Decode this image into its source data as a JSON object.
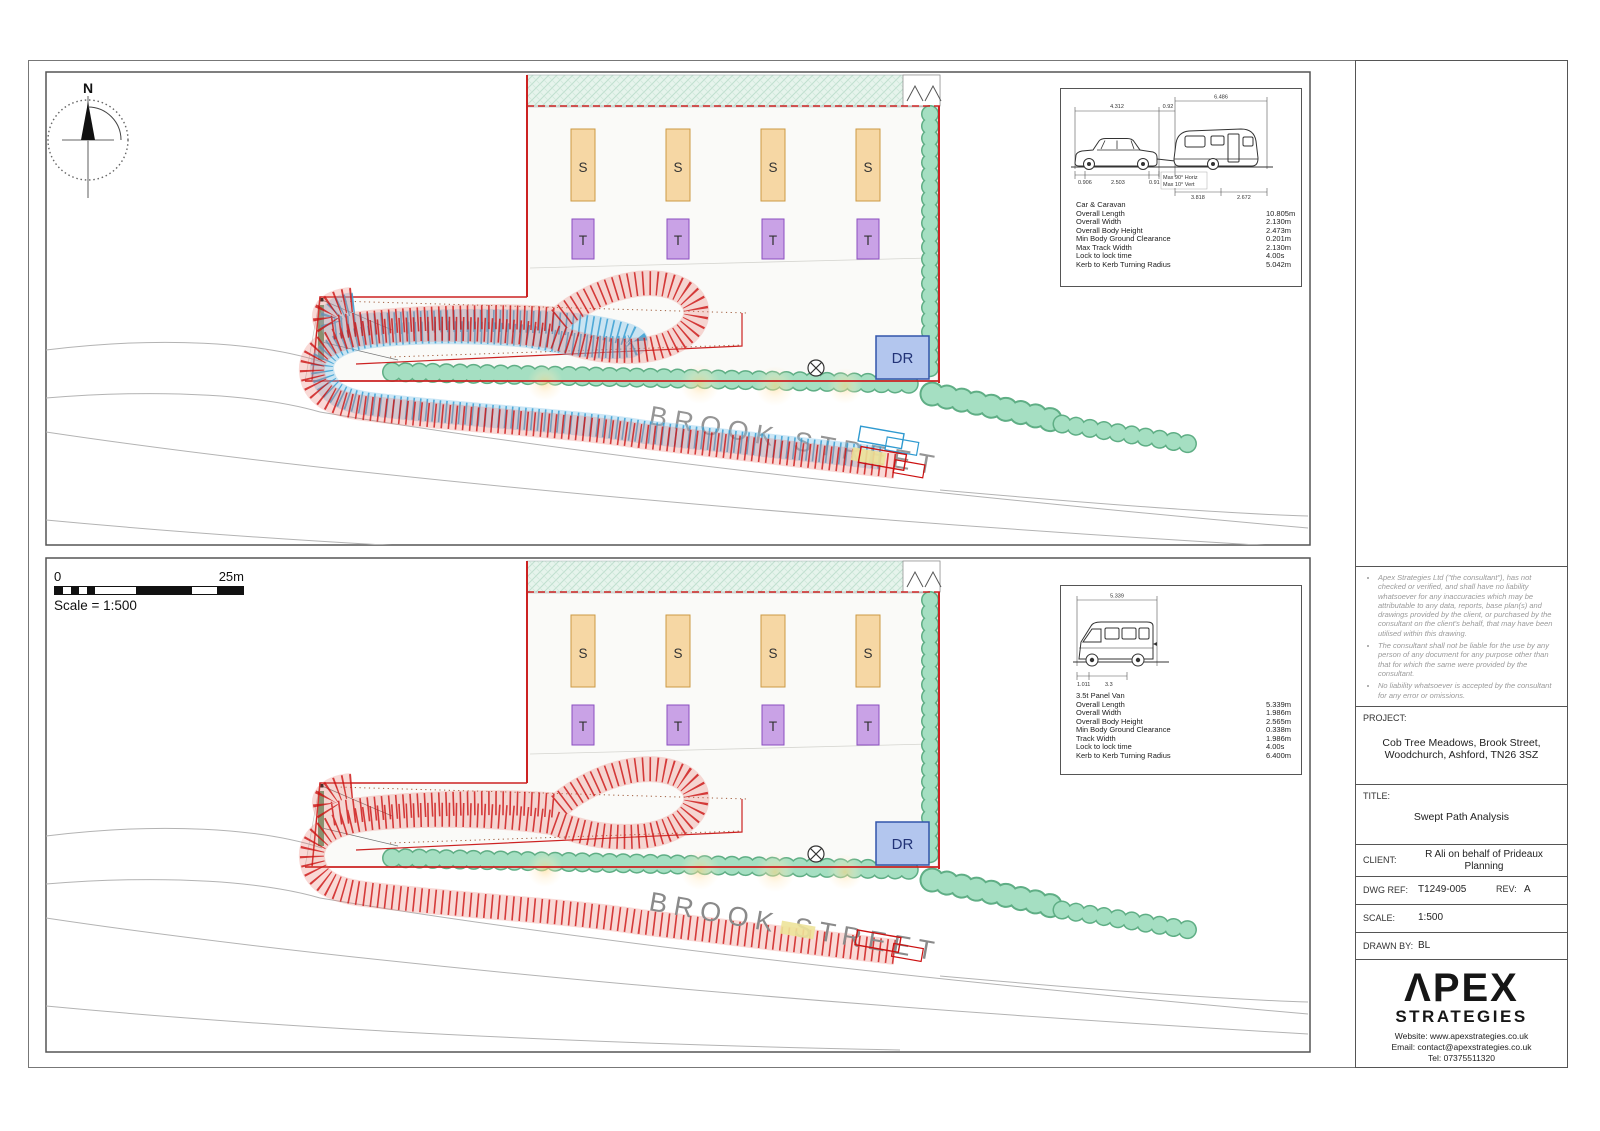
{
  "document": {
    "compass_label": "N",
    "scale_bar": {
      "start": "0",
      "end": "25m",
      "caption": "Scale = 1:500"
    },
    "site": {
      "pitch_s": "S",
      "pitch_t": "T",
      "dr": "DR",
      "street": "BROOK STREET"
    }
  },
  "spec_caravan": {
    "title": "Car & Caravan",
    "dims_top": [
      "4.312",
      "0.92",
      "6.486"
    ],
    "dims_bottom": [
      "0.906",
      "2.503",
      "0.91",
      "3.818",
      "2.672"
    ],
    "annotations": [
      "Max 90° Horiz",
      "Max 10° Vert"
    ],
    "rows": [
      {
        "label": "Overall Length",
        "value": "10.805m"
      },
      {
        "label": "Overall Width",
        "value": "2.130m"
      },
      {
        "label": "Overall Body Height",
        "value": "2.473m"
      },
      {
        "label": "Min Body Ground Clearance",
        "value": "0.201m"
      },
      {
        "label": "Max Track Width",
        "value": "2.130m"
      },
      {
        "label": "Lock to lock time",
        "value": "4.00s"
      },
      {
        "label": "Kerb to Kerb Turning Radius",
        "value": "5.042m"
      }
    ]
  },
  "spec_van": {
    "title": "3.5t Panel Van",
    "dims_top": [
      "5.339"
    ],
    "dims_bottom": [
      "1.011",
      "3.3"
    ],
    "rows": [
      {
        "label": "Overall Length",
        "value": "5.339m"
      },
      {
        "label": "Overall Width",
        "value": "1.986m"
      },
      {
        "label": "Overall Body Height",
        "value": "2.565m"
      },
      {
        "label": "Min Body Ground Clearance",
        "value": "0.338m"
      },
      {
        "label": "Track Width",
        "value": "1.986m"
      },
      {
        "label": "Lock to lock time",
        "value": "4.00s"
      },
      {
        "label": "Kerb to Kerb Turning Radius",
        "value": "6.400m"
      }
    ]
  },
  "title_block": {
    "notes": [
      "Apex Strategies Ltd (\"the consultant\"), has not checked or verified, and shall have no liability whatsoever for any inaccuracies which may be attributable to any data, reports, base plan(s) and drawings provided by the client, or purchased by the consultant on the client's behalf, that may have been utilised within this drawing.",
      "The consultant shall not be liable for the use by any person of any document for any purpose other than that for which the same were provided by the consultant.",
      "No liability whatsoever is accepted by the consultant for any error or omissions."
    ],
    "project_label": "PROJECT:",
    "project": "Cob Tree Meadows, Brook Street, Woodchurch, Ashford, TN26 3SZ",
    "title_label": "TITLE:",
    "title": "Swept Path Analysis",
    "client_label": "CLIENT:",
    "client": "R Ali on behalf of Prideaux Planning",
    "dwg_ref_label": "DWG REF:",
    "dwg_ref": "T1249-005",
    "rev_label": "REV:",
    "rev": "A",
    "scale_label": "SCALE:",
    "scale": "1:500",
    "drawn_by_label": "DRAWN BY:",
    "drawn_by": "BL",
    "logo": {
      "word1": "ΛPEX",
      "word2": "STRATEGIES",
      "website": "Website: www.apexstrategies.co.uk",
      "email": "Email: contact@apexstrategies.co.uk",
      "tel": "Tel: 07375511320"
    }
  },
  "colors": {
    "boundary_red": "#cc2222",
    "sweep_red": "#cc1111",
    "sweep_blue": "#2f9ad0",
    "hedge_green": "#9fdcbe",
    "pitch_s_fill": "#f6d7a4",
    "pitch_t_fill": "#c9a2e6",
    "dr_fill": "#b3c6ee"
  }
}
